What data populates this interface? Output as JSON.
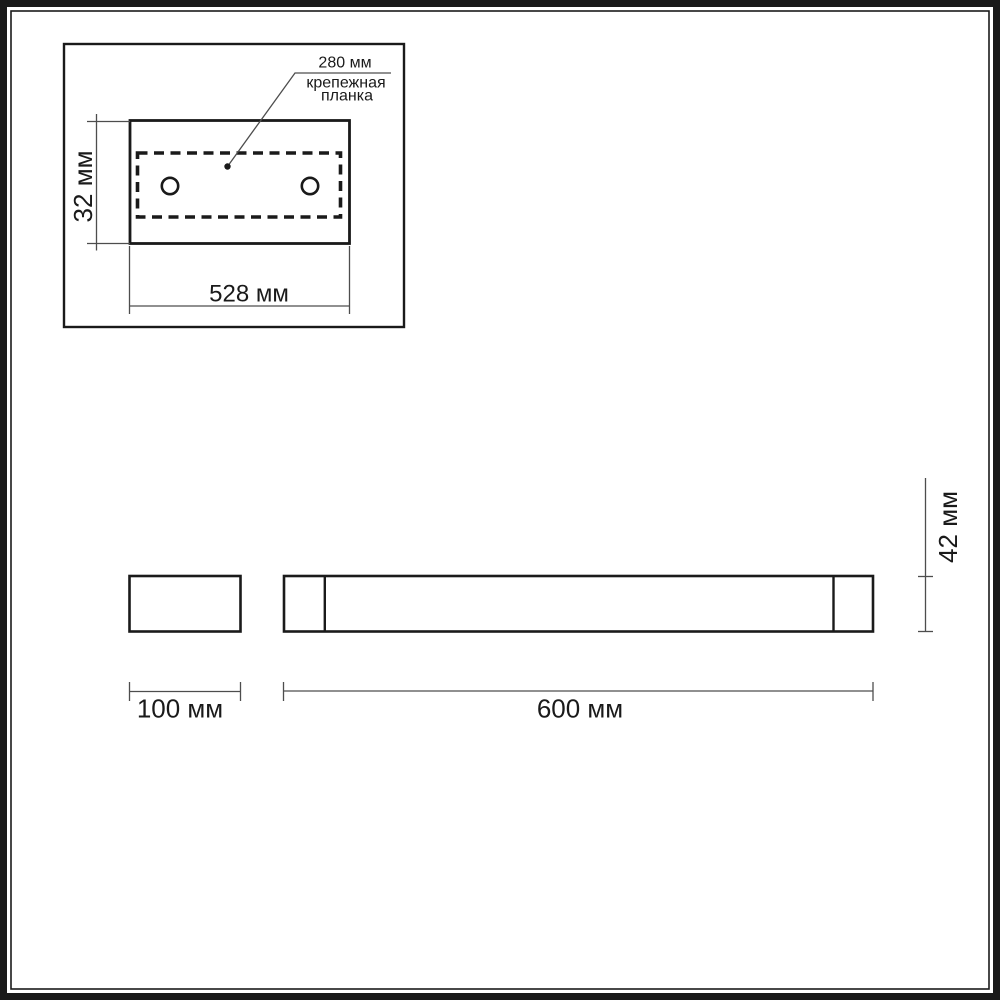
{
  "detail_panel": {
    "hole_span_label": "280 мм",
    "mounting_plate_label_line1": "крепежная",
    "mounting_plate_label_line2": "планка",
    "plate_height_label": "32 мм",
    "plate_width_label": "528 мм"
  },
  "side_view": {
    "depth_label": "100 мм"
  },
  "front_view": {
    "length_label": "600 мм",
    "height_label": "42 мм"
  },
  "dimensions_mm": {
    "hole_span": 280,
    "plate_height": 32,
    "plate_width": 528,
    "depth": 100,
    "length": 600,
    "height": 42
  },
  "colors": {
    "background": "#ffffff",
    "ink": "#1a1a1a",
    "outline": "#1a1a1a",
    "dimension": "#4d4d4d"
  }
}
